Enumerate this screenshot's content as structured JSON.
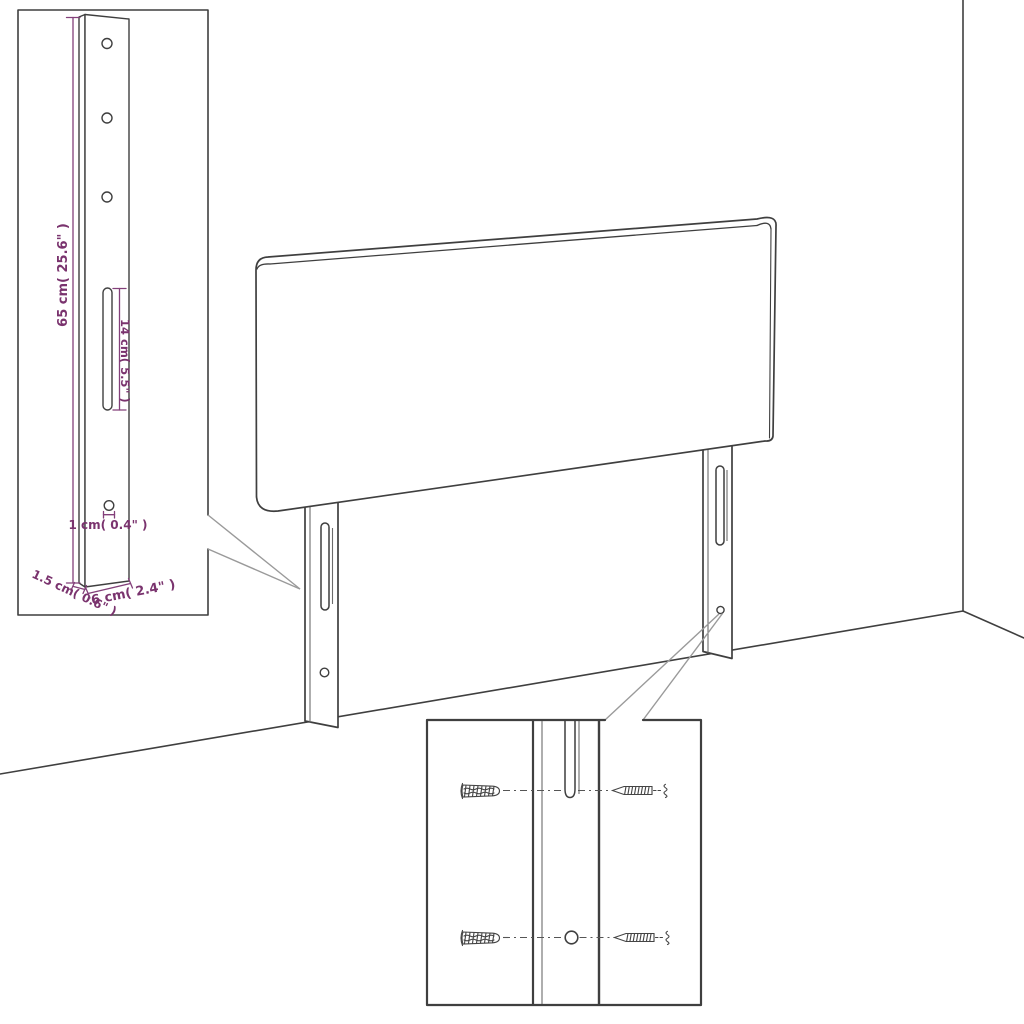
{
  "diagram_title": "headboard-with-legs-assembly-diagram",
  "labels": {
    "bracket_height": "65 cm( 25.6\" )",
    "bracket_slot": "14 cm( 5.5\" )",
    "bracket_hole": "1 cm( 0.4\" )",
    "bracket_thickness": "1.5 cm( 0.6\" )",
    "bracket_width": "6 cm( 2.4\" )"
  },
  "colors": {
    "outline": "#3f3f3f",
    "dimension_text": "#7a336e",
    "dimension_line": "#83407a",
    "callout_line": "#9a9a9a",
    "background": "#ffffff"
  }
}
